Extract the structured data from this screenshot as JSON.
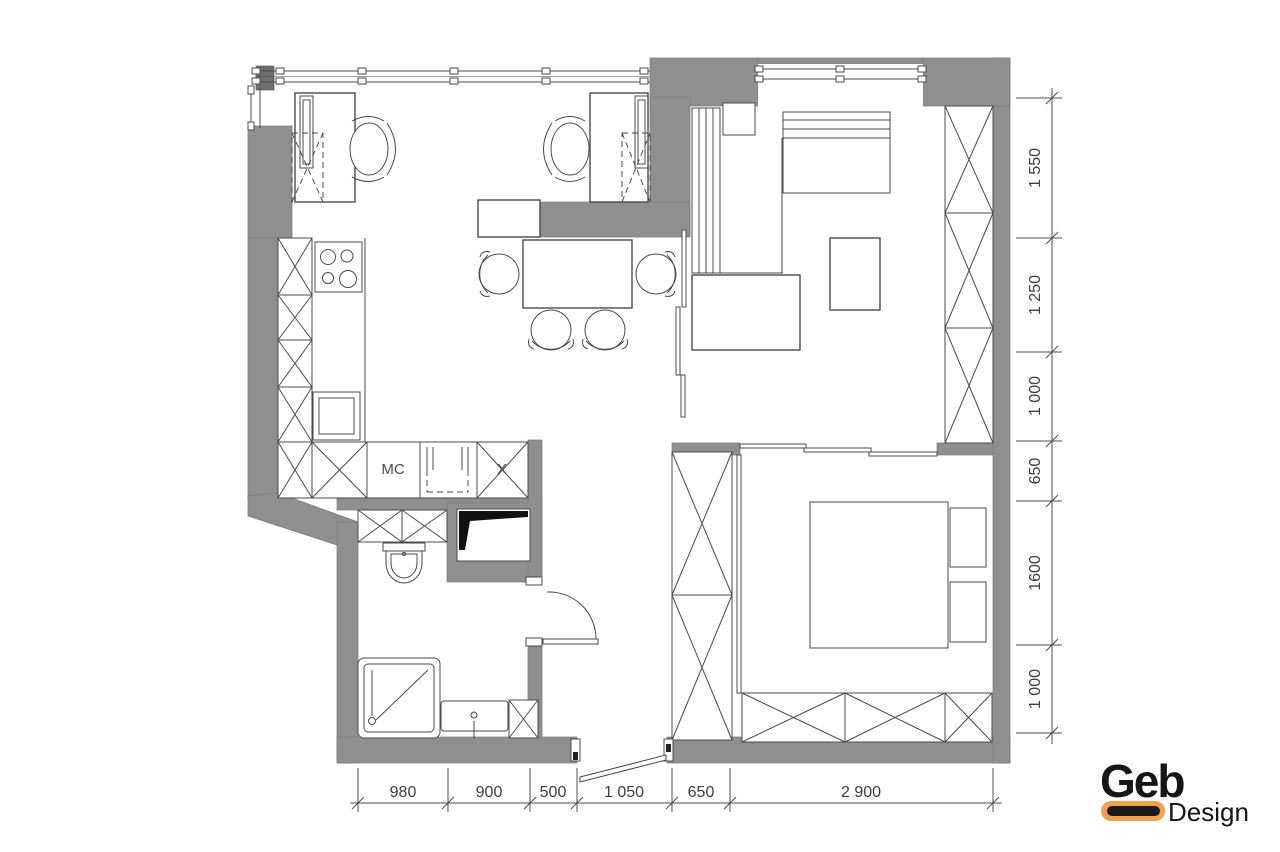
{
  "plan": {
    "labels": {
      "mc": "MC",
      "x_cabinet": "X"
    },
    "dimensions": {
      "bottom": [
        {
          "label": "980"
        },
        {
          "label": "900"
        },
        {
          "label": "500"
        },
        {
          "label": "1 050"
        },
        {
          "label": "650"
        },
        {
          "label": "2 900"
        }
      ],
      "right": [
        {
          "label": "1 550"
        },
        {
          "label": "1 250"
        },
        {
          "label": "1 000"
        },
        {
          "label": "650"
        },
        {
          "label": "1600"
        },
        {
          "label": "1 000"
        }
      ]
    },
    "logo": {
      "brand": "Geb",
      "sub": "Design"
    },
    "colors": {
      "wall": "#8f8f8f",
      "line": "#4b4b4b",
      "accent": "#EFA14B",
      "text": "#3e3e3e"
    }
  }
}
